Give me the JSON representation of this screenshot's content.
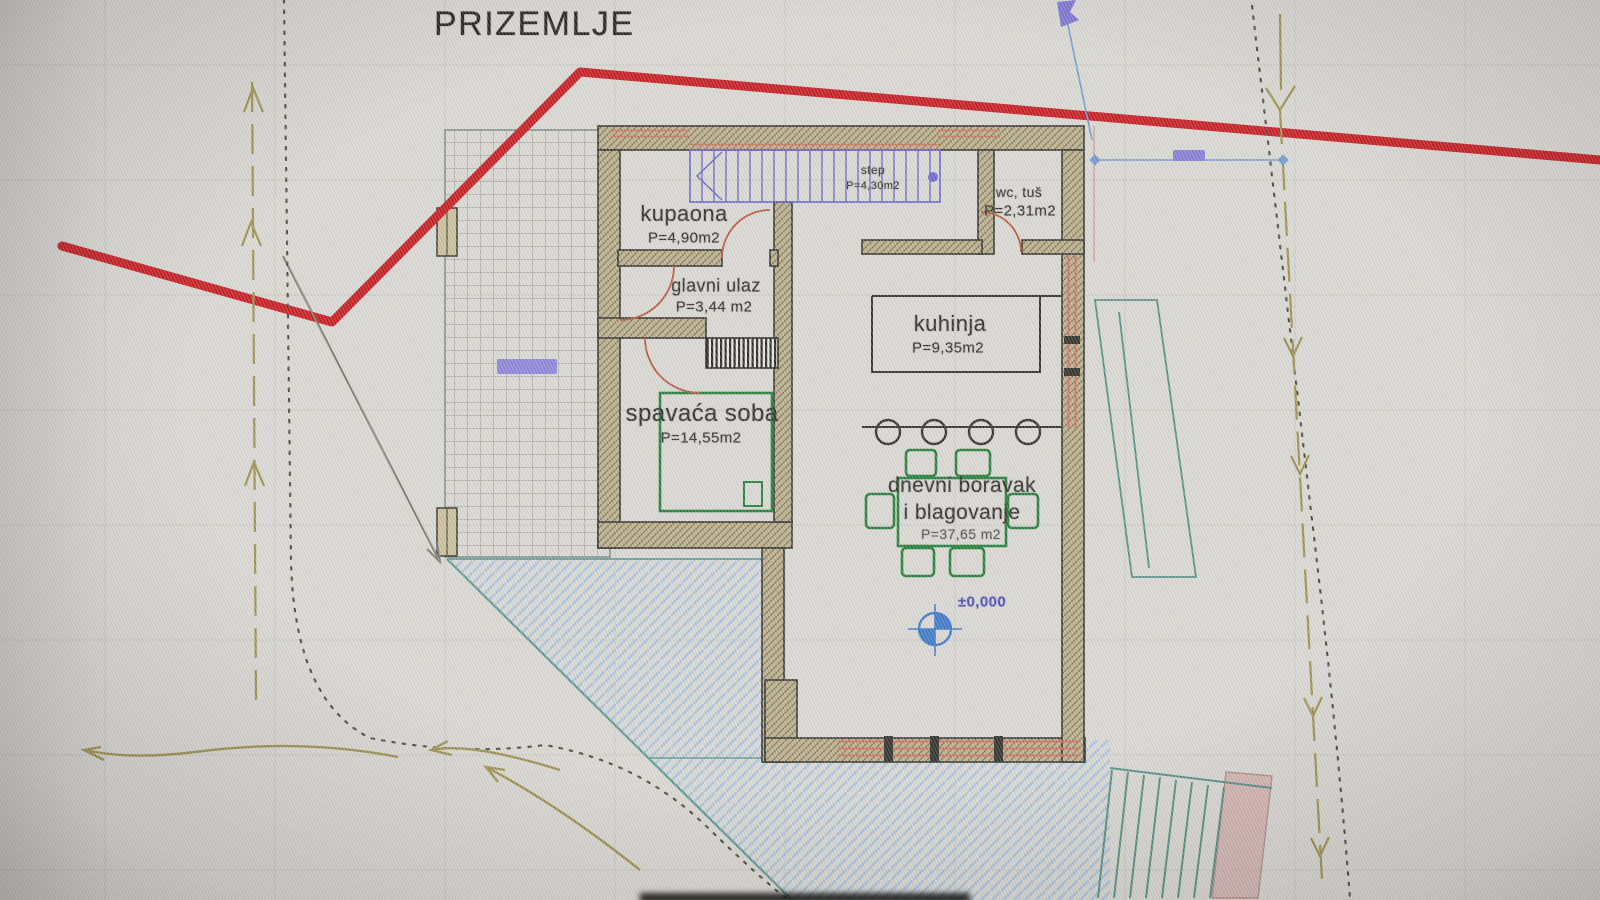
{
  "title": "PRIZEMLJE",
  "rooms": {
    "bathroom": {
      "name": "kupaona",
      "area": "P=4,90m2"
    },
    "entrance": {
      "name": "glavni ulaz",
      "area": "P=3,44 m2"
    },
    "bedroom": {
      "name": "spavaća soba",
      "area": "P=14,55m2"
    },
    "kitchen": {
      "name": "kuhinja",
      "area": "P=9,35m2"
    },
    "wc": {
      "name": "wc, tuš",
      "area": "P=2,31m2"
    },
    "living": {
      "line1": "dnevni boravak",
      "line2": "i blagovanje",
      "area": "P=37,65 m2"
    },
    "stairs": {
      "name": "step",
      "area": "P=4,30m2"
    }
  },
  "annotations": {
    "elevation_level": "±0,000"
  },
  "colors": {
    "boundary_line": "#c3161b",
    "stairs_blue": "#5d5dc4",
    "furniture_green": "#1d7a33",
    "slope_hatch_blue": "#a9c3dc",
    "terrain_teal": "#5a948c",
    "survey_olive": "#9a8d4a",
    "door_arc": "#b5543b",
    "wall_fill": "#b9ae8a",
    "elevation_blue": "#3a75c4",
    "grip_purple": "#8379d6"
  }
}
